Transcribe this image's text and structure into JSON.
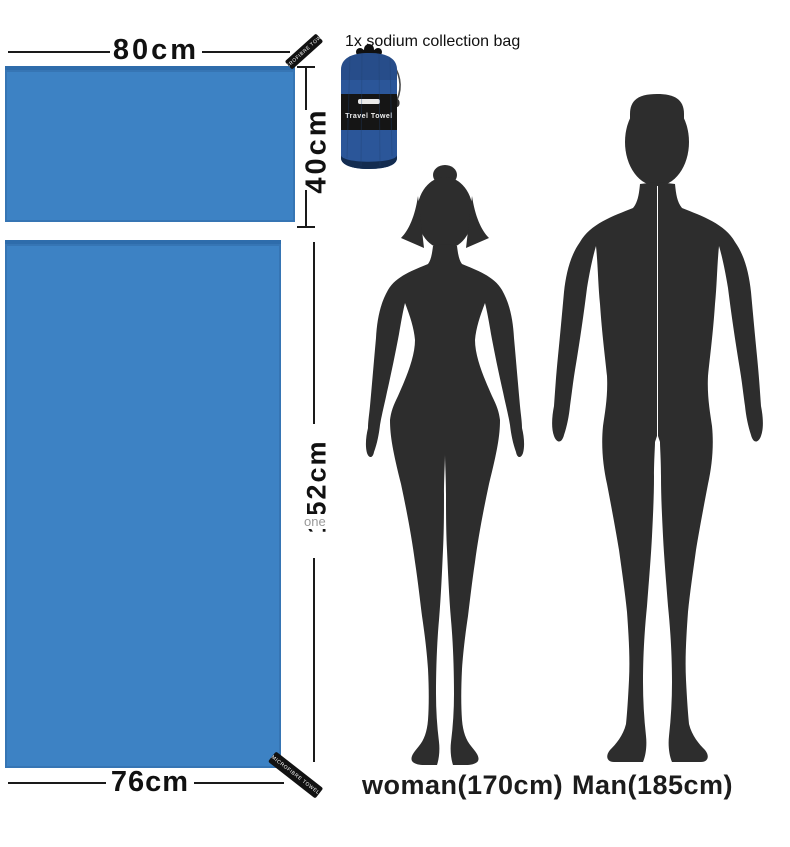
{
  "caption": {
    "bag_note": "1x sodium collection bag"
  },
  "dimensions": {
    "small_towel_width": "80cm",
    "small_towel_height": "40cm",
    "large_towel_height": "152cm",
    "large_towel_width": "76cm"
  },
  "towels": {
    "fill_color": "#3d82c4",
    "edge_color": "#2e6cab",
    "small_tag_text": "MICROFIBRE TOWEL",
    "large_tag_text": "MICROFIBRE TOWEL"
  },
  "bag": {
    "band_text": "Travel Towel",
    "body_color": "#2b5699",
    "band_color": "#151515"
  },
  "watermark": {
    "text": "one"
  },
  "figures": {
    "woman": {
      "name": "woman",
      "height": "(170cm)",
      "silhouette_color": "#2d2d2d"
    },
    "man": {
      "name": "Man",
      "height": "(185cm)",
      "silhouette_color": "#2d2d2d"
    }
  }
}
